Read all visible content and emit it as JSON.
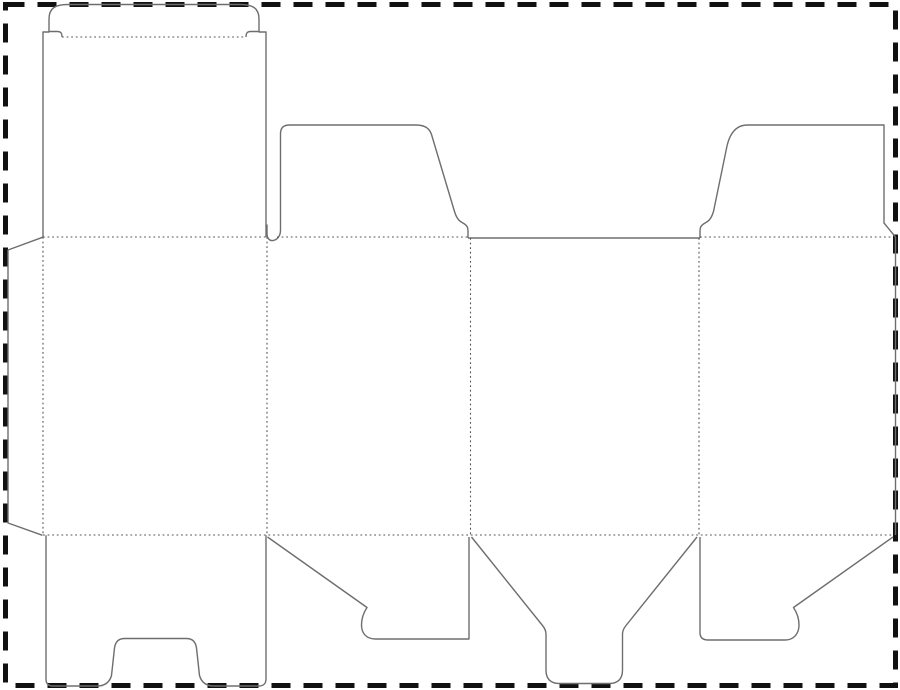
{
  "canvas": {
    "width": 900,
    "height": 690,
    "background": "#ffffff"
  },
  "diagram": {
    "kind": "packaging-dieline",
    "description": "Flat die-cut template for a tuck-top folding carton: glue flap, back panel with tuck lid, two side panels with top dust flaps, front panel, and bottom lock/tongue/dust flaps"
  },
  "styles": {
    "cut_line": {
      "color": "#6e6e6e",
      "width": 1.4,
      "dash": "none"
    },
    "fold_line": {
      "color": "#555555",
      "width": 1.1,
      "dash": "1.8 2.8"
    },
    "border_line": {
      "color": "#111111",
      "width": 5,
      "dash": "19 13"
    }
  },
  "border": {
    "x": 5.5,
    "y": 4.5,
    "width": 890,
    "height": 681
  },
  "shapes": [
    {
      "name": "back-panel-and-lid-outline",
      "kind": "cut",
      "d": "M 43,237 L 43,32 L 49,32 L 49,19 C 49,8 55.5,4.5 68,4.5 L 240,4.5 C 252.5,4.5 259,8 259,19 L 259,32 L 266,32 L 266,237"
    },
    {
      "name": "tuck-shoulder-slit-left",
      "kind": "cut",
      "d": "M 49,31.5 L 57.5,31.5 C 60.8,31.5 62,33.2 62,37"
    },
    {
      "name": "tuck-shoulder-slit-right",
      "kind": "cut",
      "d": "M 259,31.5 L 250.5,31.5 C 247.2,31.5 246,33.2 246,37"
    },
    {
      "name": "glue-flap-outline",
      "kind": "cut",
      "d": "M 42.5,237.3 L 8,250 L 8,523 L 42.5,535.3"
    },
    {
      "name": "top-dust-flap-left-outline",
      "kind": "cut",
      "d": "M 267,224.5 L 267,233 C 267,238.5 269.5,241 273,240.5 C 277,239.8 280.5,236.5 280.5,230 L 280.5,134 C 280.5,127.5 283.5,125 290,125 L 416,125 C 424,125 429.5,128 431.5,134.5 L 454.5,211.5 C 456,216.5 457.5,219.5 460.5,221.5 L 464.5,224 C 467,225.5 468,227.5 468,230.5 L 468,238"
    },
    {
      "name": "front-panel-top-edge",
      "kind": "cut",
      "d": "M 468,238 L 700,238"
    },
    {
      "name": "top-dust-flap-right-outline",
      "kind": "cut",
      "d": "M 700,238 L 700,230.5 C 700,227.5 701,225.5 703.5,224 L 707.5,221.5 C 710.5,219.5 712,216.5 713.5,211.5 L 727,146 C 730,133 736,125 747.5,125 L 884,125 L 884,223 L 895.5,237"
    },
    {
      "name": "sheet-right-edge",
      "kind": "cut",
      "d": "M 895.5,237 L 895.5,535"
    },
    {
      "name": "bottom-lock-flap-outline",
      "kind": "cut",
      "d": "M 46,535.3 L 46,679 C 46,684 48.5,686 53,686 L 97,686 C 104.5,686 109.5,682.5 111.5,675.5 L 114.5,648 C 115.5,641.5 118.5,638.5 125,638.5 L 186,638.5 C 192.5,638.5 195.5,641.5 196.5,648 L 199.5,675.5 C 201.5,682.5 206.5,686 214,686 L 259,686 C 263.5,686 266,683.5 266,679 L 266,535.3"
    },
    {
      "name": "bottom-dust-flap-left-outline",
      "kind": "cut",
      "d": "M 267.5,537 L 367,607.5 C 364,612 361.5,618 361.5,625 C 361.5,633.5 366.5,639 375.5,639 L 469,639 L 469,537"
    },
    {
      "name": "bottom-tongue-flap-outline",
      "kind": "cut",
      "d": "M 471.5,537 L 542.5,625.5 C 544.5,628 546,630.5 546,634 L 546,670 C 546,679 550.5,683.5 559.5,683.5 L 609,683.5 C 618,683.5 622.5,679 622.5,670 L 622.5,634 C 622.5,630.5 624,628 626,625.5 L 697,537"
    },
    {
      "name": "bottom-dust-flap-right-outline",
      "kind": "cut",
      "d": "M 700,537 L 700,632.5 C 700,637.5 702.5,640 708,640 L 785,640 C 794,640 799,633.5 799,625 C 799,618 796.5,612 793.5,607.5 L 893,537"
    },
    {
      "name": "tuck-fold-line",
      "kind": "fold",
      "d": "M 62,37 L 246,37"
    },
    {
      "name": "top-fold-back-panel",
      "kind": "fold",
      "d": "M 43,237 L 267,237"
    },
    {
      "name": "top-fold-dust-flap-left",
      "kind": "fold",
      "d": "M 277,237 L 468,237"
    },
    {
      "name": "top-fold-dust-flap-right",
      "kind": "fold",
      "d": "M 700,237 L 893,237"
    },
    {
      "name": "bottom-fold-line",
      "kind": "fold",
      "d": "M 43,535 L 893,535"
    },
    {
      "name": "vertical-fold-glue-flap",
      "kind": "fold",
      "d": "M 43,237 L 43,535"
    },
    {
      "name": "vertical-fold-back-side",
      "kind": "fold",
      "d": "M 267,237 L 267,535"
    },
    {
      "name": "vertical-fold-side-front",
      "kind": "fold",
      "d": "M 470.5,238 L 470.5,535"
    },
    {
      "name": "vertical-fold-front-side",
      "kind": "fold",
      "d": "M 699,238 L 699,535"
    }
  ]
}
